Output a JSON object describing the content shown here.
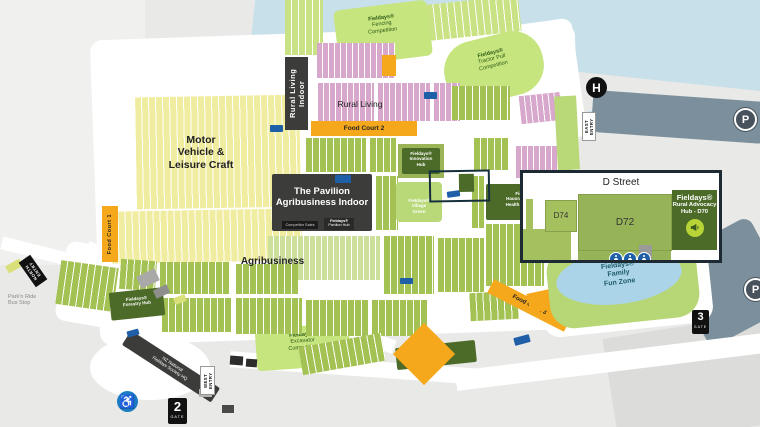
{
  "brand": "Fieldays®",
  "areas": {
    "rural_living_indoor": "Rural Living Indoor",
    "rural_living": "Rural Living",
    "motor_vehicle": "Motor\nVehicle &\nLeisure Craft",
    "agribusiness": "Agribusiness",
    "pavilion": "The Pavilion\nAgribusiness Indoor",
    "pavilion_tag_sales": "Competitor Sales",
    "pavilion_tag_hub": "Pavilion Hub",
    "fencing": "Fencing\nCompetition",
    "tractor_pull": "Tractor Pull\nCompetition",
    "excavator": "Excavator\nCompetition",
    "drone_zone": "Drone Zone",
    "forestry_hub": "Forestry Hub",
    "innovation_hub": "Innovation\nHub",
    "village_green": "Village\nGreen",
    "hauora": "Hauora Taiwhenua\nHealth & Wellbeing",
    "family_fun": "Family\nFun Zone",
    "society_hq": "NZ National\nFieldays Society HQ",
    "parknride": "Park'n Ride\nBus Stop"
  },
  "food_courts": {
    "fc1": "Food Court 1",
    "fc2": "Food Court 2",
    "fc3": "Food Court 3"
  },
  "entries": {
    "north": "NORTH ENTRY",
    "west": "WEST ENTRY",
    "east": "EAST ENTRY"
  },
  "gates": [
    {
      "num": "2",
      "word": "GATE"
    },
    {
      "num": "3",
      "word": "GATE"
    }
  ],
  "icons": {
    "helipad": "H",
    "parking": "P",
    "accessibility": "♿"
  },
  "inset": {
    "street": "D Street",
    "d74": "D74",
    "d72": "D72",
    "hub_name": "Rural Advocacy\nHub - D70"
  },
  "colors": {
    "ground": "#e9e9e7",
    "river": "#c7e0ea",
    "lake": "#abd4e8",
    "parking": "#7b909c",
    "stall_pink": "#d8a8cc",
    "stall_yellow": "#f0eda0",
    "stall_green": "#a4c254",
    "competition_green": "#c6e57e",
    "hub_dark_green": "#4c6b28",
    "food_orange": "#f5a81c",
    "building_dark": "#3c3c3a",
    "toilet_blue": "#1f5fa8",
    "advocacy_lime": "#b8d437"
  }
}
